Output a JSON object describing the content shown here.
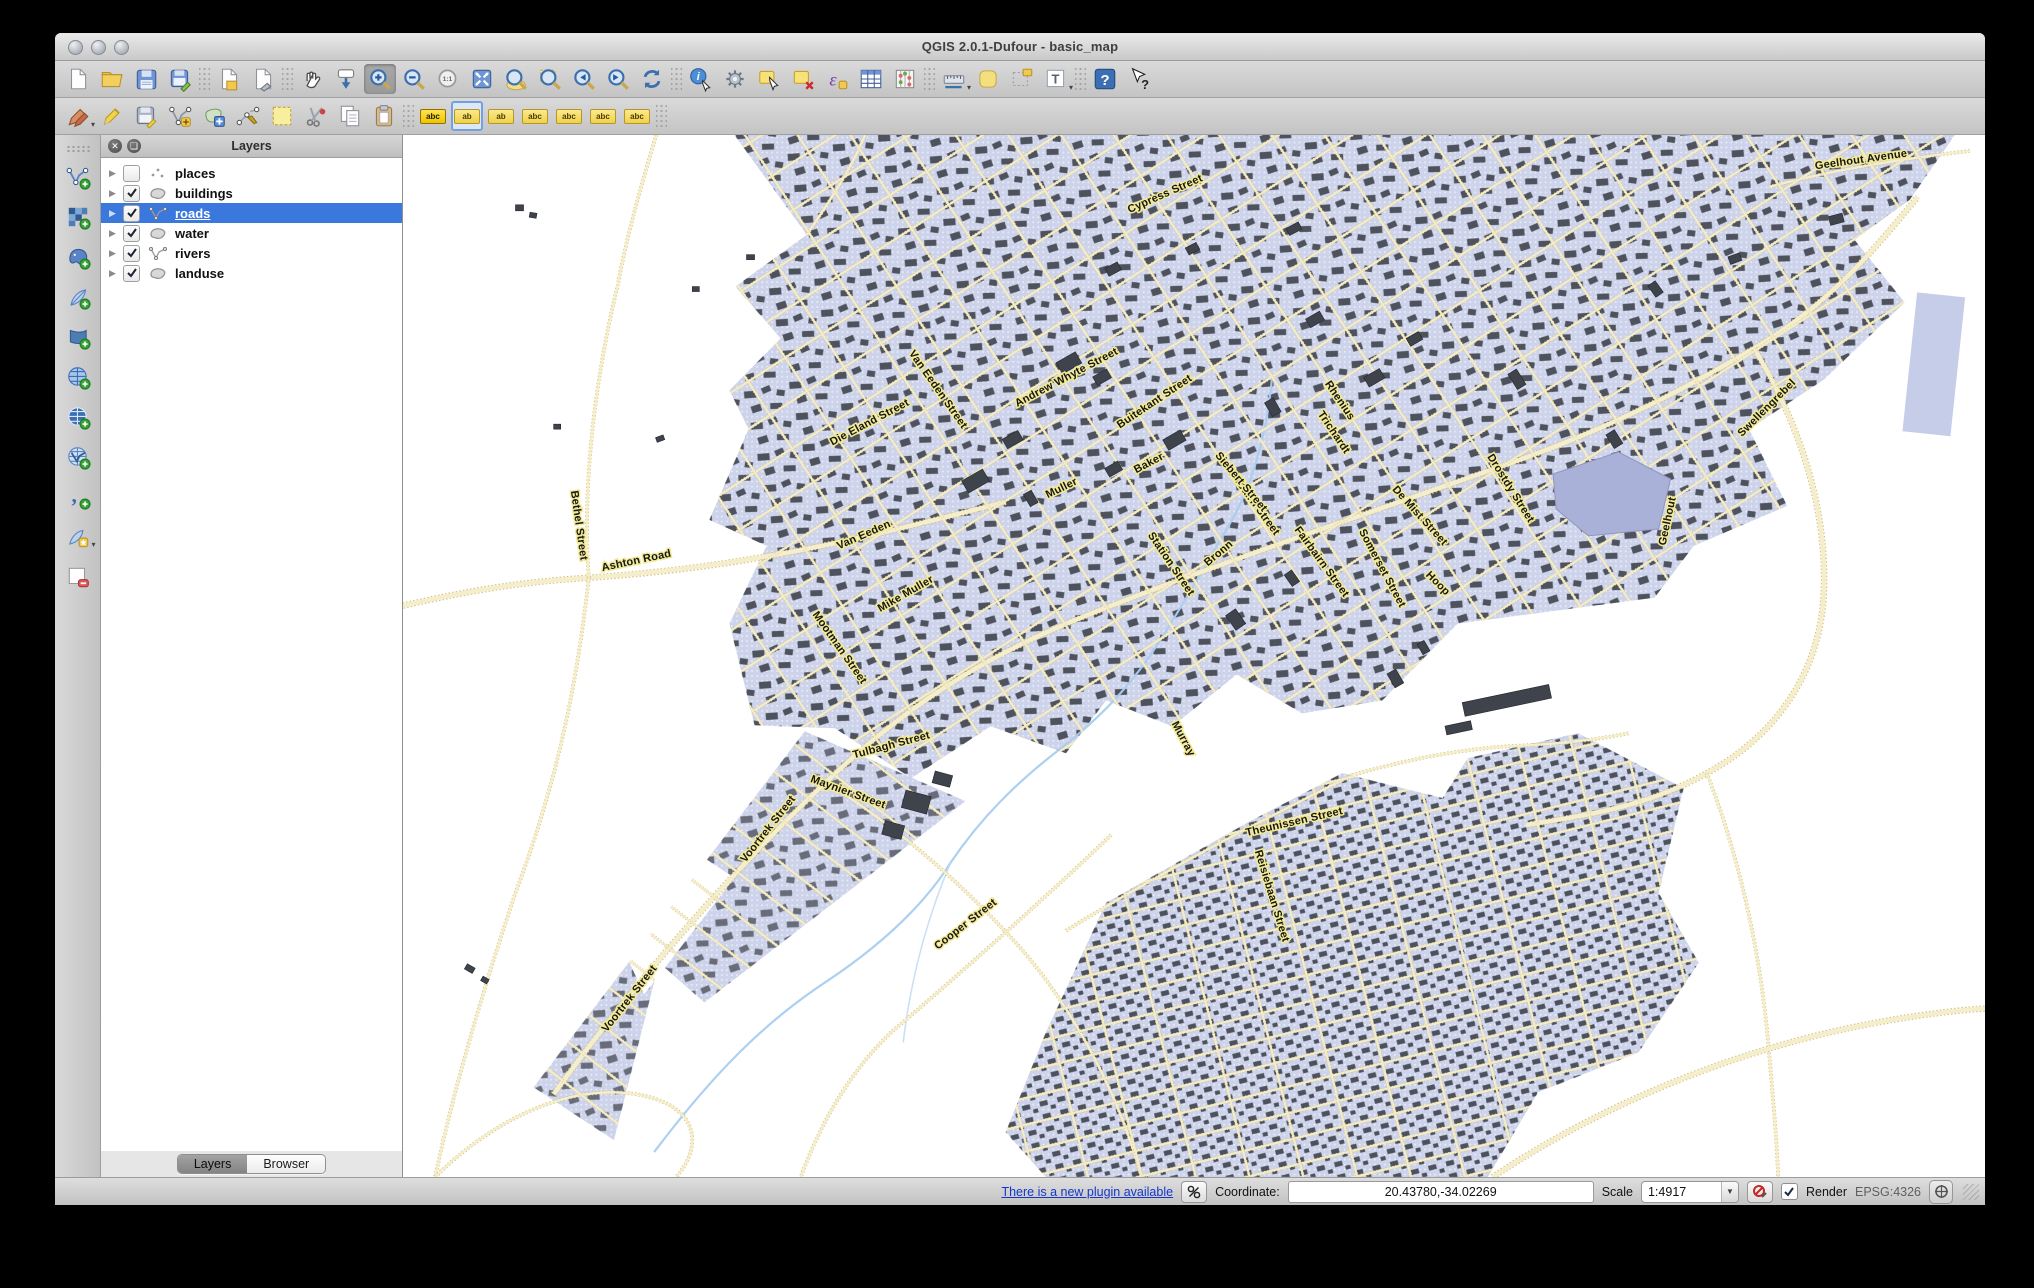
{
  "window": {
    "title": "QGIS 2.0.1-Dufour - basic_map"
  },
  "toolbar_row1": [
    {
      "name": "new-project-icon"
    },
    {
      "name": "open-project-icon"
    },
    {
      "name": "save-project-icon"
    },
    {
      "name": "save-project-as-icon"
    },
    {
      "sep": true
    },
    {
      "name": "new-composer-icon"
    },
    {
      "name": "composer-manager-icon"
    },
    {
      "sep": true
    },
    {
      "name": "pan-map-icon"
    },
    {
      "name": "pan-to-selection-icon"
    },
    {
      "name": "zoom-in-icon",
      "active": true
    },
    {
      "name": "zoom-out-icon"
    },
    {
      "name": "zoom-native-icon"
    },
    {
      "name": "zoom-full-icon"
    },
    {
      "name": "zoom-to-layer-icon"
    },
    {
      "name": "zoom-to-selection-icon"
    },
    {
      "name": "zoom-last-icon"
    },
    {
      "name": "zoom-next-icon"
    },
    {
      "name": "refresh-icon"
    },
    {
      "sep": true
    },
    {
      "name": "identify-icon"
    },
    {
      "name": "run-feature-action-icon"
    },
    {
      "name": "select-features-icon"
    },
    {
      "name": "deselect-features-icon"
    },
    {
      "name": "select-by-expression-icon"
    },
    {
      "name": "attribute-table-icon"
    },
    {
      "name": "field-calculator-icon"
    },
    {
      "sep": true
    },
    {
      "name": "measure-icon",
      "dd": true
    },
    {
      "name": "new-bookmark-icon"
    },
    {
      "name": "show-bookmarks-icon"
    },
    {
      "name": "text-annotation-icon",
      "dd": true
    },
    {
      "sep": true
    },
    {
      "name": "help-icon"
    },
    {
      "name": "whats-this-icon"
    }
  ],
  "toolbar_row2": [
    {
      "name": "current-edits-icon",
      "dd": true
    },
    {
      "name": "toggle-editing-icon"
    },
    {
      "name": "save-edits-icon"
    },
    {
      "name": "add-feature-icon"
    },
    {
      "name": "move-feature-icon"
    },
    {
      "name": "node-tool-icon"
    },
    {
      "name": "delete-selected-icon"
    },
    {
      "name": "cut-features-icon"
    },
    {
      "name": "copy-features-icon"
    },
    {
      "name": "paste-features-icon"
    },
    {
      "sep": true
    },
    {
      "name": "labeling-options-icon",
      "tag": "abc",
      "strong": true
    },
    {
      "name": "move-label-icon",
      "tag": "ab",
      "selected": true
    },
    {
      "name": "rotate-label-icon",
      "tag": "ab"
    },
    {
      "name": "pin-labels-icon",
      "tag": "abc"
    },
    {
      "name": "show-hidden-labels-icon",
      "tag": "abc"
    },
    {
      "name": "change-label-icon",
      "tag": "abc"
    },
    {
      "name": "label-properties-icon",
      "tag": "abc"
    },
    {
      "sep": true
    }
  ],
  "side_toolbar": [
    {
      "name": "add-vector-layer-icon"
    },
    {
      "name": "add-raster-layer-icon"
    },
    {
      "name": "add-postgis-layer-icon"
    },
    {
      "name": "add-spatialite-layer-icon"
    },
    {
      "name": "add-mssql-layer-icon"
    },
    {
      "name": "add-wms-layer-icon"
    },
    {
      "name": "add-wcs-layer-icon"
    },
    {
      "name": "add-wfs-layer-icon"
    },
    {
      "name": "add-delimited-text-icon"
    },
    {
      "name": "new-shapefile-layer-icon",
      "dd": true
    },
    {
      "name": "remove-layer-icon"
    }
  ],
  "layers_panel": {
    "title": "Layers",
    "layers": [
      {
        "label": "places",
        "checked": false,
        "geom": "point",
        "selected": false
      },
      {
        "label": "buildings",
        "checked": true,
        "geom": "polygon",
        "selected": false
      },
      {
        "label": "roads",
        "checked": true,
        "geom": "line",
        "selected": true
      },
      {
        "label": "water",
        "checked": true,
        "geom": "polygon",
        "selected": false
      },
      {
        "label": "rivers",
        "checked": true,
        "geom": "line",
        "selected": false
      },
      {
        "label": "landuse",
        "checked": true,
        "geom": "polygon",
        "selected": false
      }
    ],
    "tabs": [
      "Layers",
      "Browser"
    ],
    "active_tab": "Layers"
  },
  "map": {
    "colors": {
      "urban": "#cdd3ea",
      "road_fill": "#f5eecd",
      "road_casing": "#d7c27c",
      "building": "#3f434c",
      "river": "#a9cdf0",
      "dam": "#aab1d8",
      "label_halo": "#f2ea96"
    },
    "labels": [
      {
        "text": "Geelhout Avenue",
        "x": 1452,
        "y": 28,
        "r": -8
      },
      {
        "text": "Ashton Road",
        "x": 233,
        "y": 430,
        "r": -12
      },
      {
        "text": "Bethel Street",
        "x": 172,
        "y": 392,
        "r": 82
      },
      {
        "text": "Voortrek Street",
        "x": 366,
        "y": 698,
        "r": -52
      },
      {
        "text": "Voortrek Street",
        "x": 228,
        "y": 868,
        "r": -52
      },
      {
        "text": "Maynier Street",
        "x": 442,
        "y": 662,
        "r": 20
      },
      {
        "text": "Tulbagh Street",
        "x": 487,
        "y": 615,
        "r": -15
      },
      {
        "text": "Cooper Street",
        "x": 562,
        "y": 794,
        "r": -38
      },
      {
        "text": "Theunissen Street",
        "x": 888,
        "y": 692,
        "r": -13
      },
      {
        "text": "Reisiebaan Street",
        "x": 862,
        "y": 764,
        "r": 73
      },
      {
        "text": "Station Street",
        "x": 762,
        "y": 432,
        "r": 56
      },
      {
        "text": "Fairbairn Street",
        "x": 843,
        "y": 368,
        "r": 54
      },
      {
        "text": "Fairbairn Street",
        "x": 912,
        "y": 430,
        "r": 54
      },
      {
        "text": "Siebert Street",
        "x": 832,
        "y": 350,
        "r": 50
      },
      {
        "text": "Buitekant Street",
        "x": 750,
        "y": 270,
        "r": -34
      },
      {
        "text": "Baker",
        "x": 744,
        "y": 332,
        "r": -28
      },
      {
        "text": "Bronn",
        "x": 814,
        "y": 422,
        "r": -40
      },
      {
        "text": "Rhenius",
        "x": 930,
        "y": 268,
        "r": 56
      },
      {
        "text": "Trichardt",
        "x": 924,
        "y": 300,
        "r": 56
      },
      {
        "text": "De Mist Street",
        "x": 1010,
        "y": 384,
        "r": 48
      },
      {
        "text": "Somerset Street",
        "x": 972,
        "y": 436,
        "r": 62
      },
      {
        "text": "Hoop",
        "x": 1028,
        "y": 452,
        "r": 45
      },
      {
        "text": "Drostdy Street",
        "x": 1100,
        "y": 356,
        "r": 58
      },
      {
        "text": "Muller",
        "x": 657,
        "y": 357,
        "r": -26
      },
      {
        "text": "Van Eeden",
        "x": 460,
        "y": 404,
        "r": -24
      },
      {
        "text": "Mike Muller",
        "x": 502,
        "y": 463,
        "r": -30
      },
      {
        "text": "Mootman Street",
        "x": 432,
        "y": 516,
        "r": 55
      },
      {
        "text": "Murray",
        "x": 774,
        "y": 607,
        "r": 62
      },
      {
        "text": "Van Eeden Street",
        "x": 530,
        "y": 257,
        "r": 55
      },
      {
        "text": "Andrew Whyte Street",
        "x": 662,
        "y": 246,
        "r": -28
      },
      {
        "text": "Die Eland Street",
        "x": 466,
        "y": 291,
        "r": -28
      },
      {
        "text": "Cypress Street",
        "x": 760,
        "y": 62,
        "r": -24
      },
      {
        "text": "Swellengrebel",
        "x": 1360,
        "y": 276,
        "r": -45
      },
      {
        "text": "Geelhout",
        "x": 1262,
        "y": 388,
        "r": -78
      }
    ]
  },
  "status_bar": {
    "plugin_link": "There is a new plugin available",
    "coordinate_label": "Coordinate:",
    "coordinate_value": "20.43780,-34.02269",
    "scale_label": "Scale",
    "scale_value": "1:4917",
    "render_label": "Render",
    "crs": "EPSG:4326"
  }
}
